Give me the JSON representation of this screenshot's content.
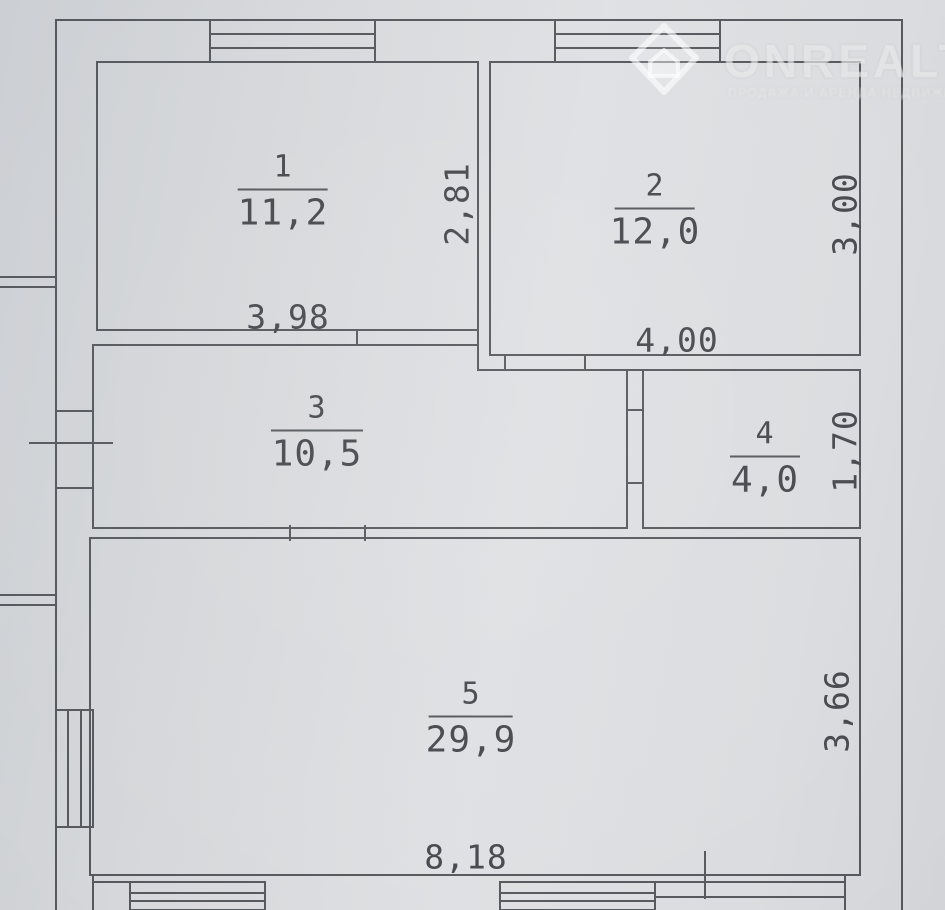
{
  "watermark": {
    "brand": "ONREALT",
    "subtitle": "ПРОДАЖА И АРЕНДА НЕДВИЖИМОСТИ",
    "logo_icon": "diamond-house-icon"
  },
  "plan": {
    "type": "floor-plan",
    "rooms": [
      {
        "number": "1",
        "area": "11,2",
        "bottom_dim": "3,98",
        "side_dim": "2,81"
      },
      {
        "number": "2",
        "area": "12,0",
        "bottom_dim": "4,00",
        "side_dim": "3,00"
      },
      {
        "number": "3",
        "area": "10,5"
      },
      {
        "number": "4",
        "area": "4,0",
        "side_dim": "1,70"
      },
      {
        "number": "5",
        "area": "29,9",
        "bottom_dim": "8,18",
        "side_dim": "3,66"
      }
    ],
    "colors": {
      "paper": "#d7d9dc",
      "line": "#55585c",
      "text": "#45484c"
    }
  }
}
